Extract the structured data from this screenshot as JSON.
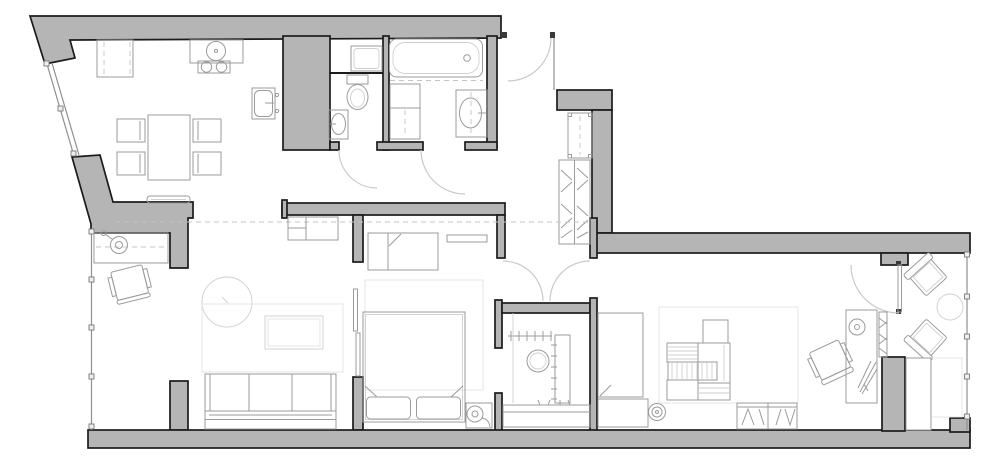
{
  "plan": {
    "type": "apartment-floor-plan",
    "background": "#ffffff",
    "colors": {
      "wall_fill": "#b5b5b5",
      "wall_line": "#1b1b1b",
      "furniture_line": "#9b9b9b",
      "light_line": "#cfcfcf",
      "door_line": "#c9c9c9",
      "glazing_line": "#8f8f8f"
    },
    "rooms": [
      {
        "name": "kitchen-dining",
        "furniture": [
          "refrigerator-cabinet",
          "counter-with-round-sink",
          "two-burner-cooktop",
          "wall-sink-unit",
          "dining-table",
          "dining-chair",
          "dining-chair",
          "dining-chair",
          "dining-chair",
          "radiator-console"
        ]
      },
      {
        "name": "wc",
        "furniture": [
          "washing-machine",
          "toilet",
          "hand-basin"
        ]
      },
      {
        "name": "bathroom",
        "furniture": [
          "bathtub",
          "tall-cabinet",
          "vanity-sink"
        ]
      },
      {
        "name": "entrance-hall",
        "furniture": [
          "entry-bench",
          "coat-closet"
        ]
      },
      {
        "name": "living-room",
        "furniture": [
          "window-desk",
          "desk-lamp",
          "office-chair",
          "round-rug",
          "area-rug",
          "coffee-table",
          "sofa",
          "tv-bench"
        ]
      },
      {
        "name": "bedroom",
        "furniture": [
          "wardrobe",
          "wall-shelf",
          "double-bed",
          "pillow",
          "pillow",
          "nightstand-lamp",
          "bedroom-rug"
        ]
      },
      {
        "name": "walk-in-closet",
        "furniture": [
          "hanging-rail",
          "shelf-tower",
          "pouf",
          "low-shelf"
        ]
      },
      {
        "name": "corridor",
        "furniture": [
          "hall-cabinet",
          "low-cabinet",
          "floor-outlet"
        ]
      },
      {
        "name": "study",
        "furniture": [
          "area-rug",
          "dresser-unit",
          "slatted-rack",
          "office-chair",
          "wall-desk",
          "desk-lamp",
          "plant",
          "mirror-panel"
        ]
      },
      {
        "name": "balcony",
        "furniture": [
          "armchair",
          "armchair",
          "round-side-table",
          "planter-box"
        ]
      }
    ],
    "doors": {
      "entrance_door_arcs": 1,
      "wc_door_arcs": 1,
      "bathroom_door_arcs": 1,
      "closet_double_door_arcs": 2,
      "study_door_arcs": 1,
      "sliding_panels": 2
    },
    "windows": {
      "angled_window_mullions": 3,
      "west_glazing_mullions": 5,
      "east_glazing_mullions": 5
    }
  }
}
